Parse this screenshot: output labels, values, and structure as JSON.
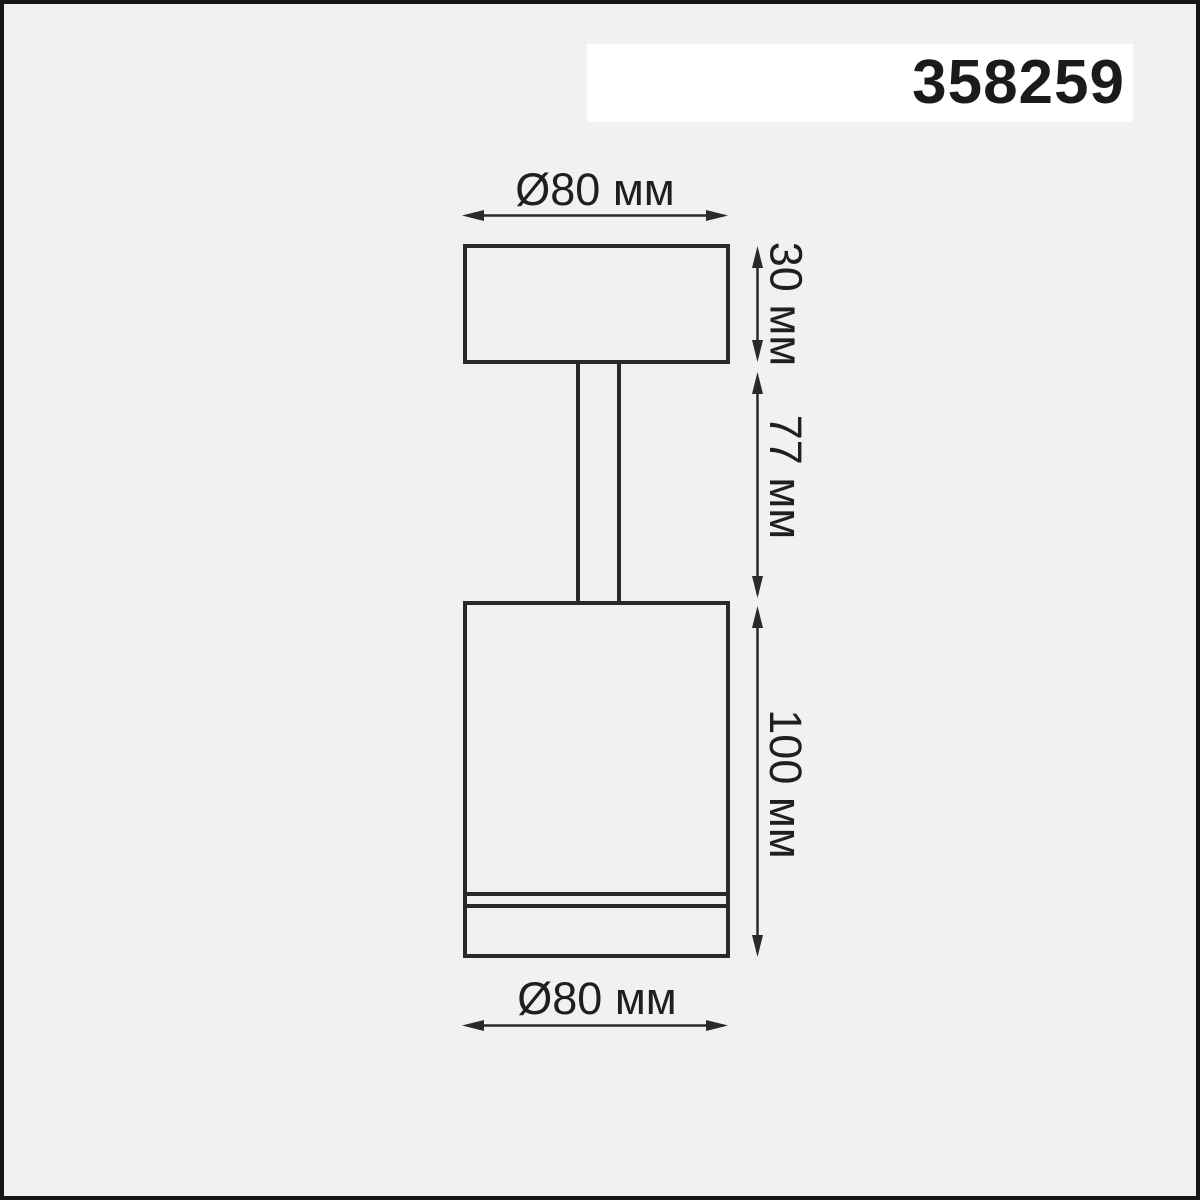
{
  "header": {
    "article_number": "358259"
  },
  "drawing": {
    "type": "technical-dimension-diagram",
    "subject": "surface-mounted spot light fixture, side elevation",
    "dimensions": {
      "top_diameter": "Ø80 мм",
      "canopy_height": "30 мм",
      "stem_length": "77 мм",
      "body_height": "100 мм",
      "bottom_diameter": "Ø80 мм"
    },
    "colors": {
      "background": "#f1f1f2",
      "line": "#2a2a2a",
      "frame": "#161616",
      "band": "#ffffff",
      "text": "#1f1f1f"
    }
  }
}
